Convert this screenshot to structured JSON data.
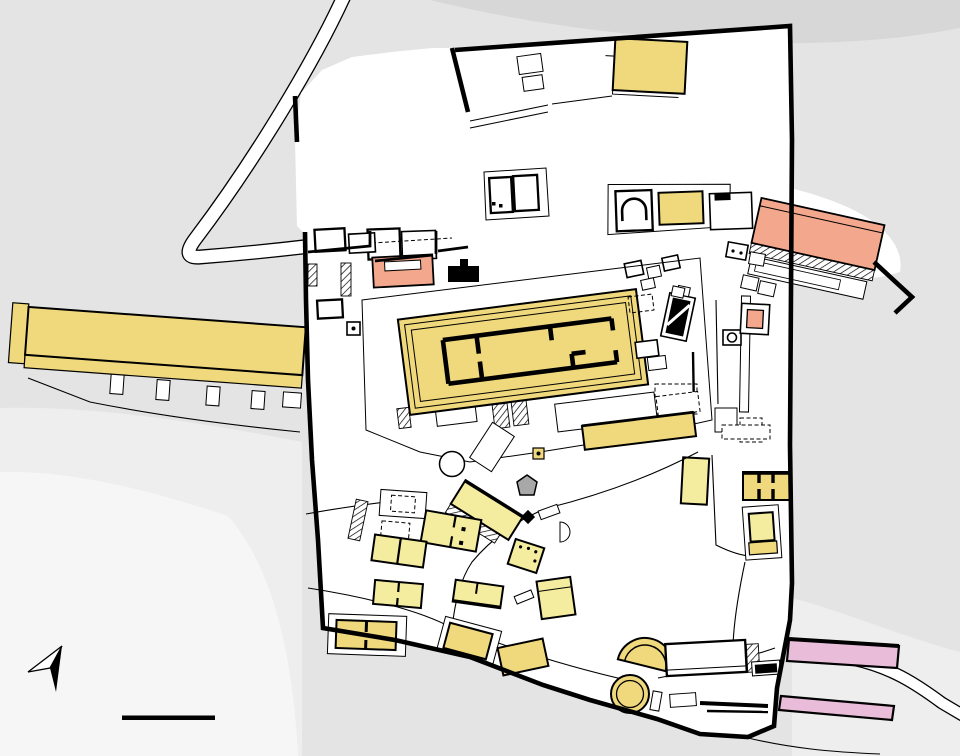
{
  "labels": [
    {
      "n": "1",
      "x": 519,
      "y": 354
    },
    {
      "n": "2",
      "x": 663,
      "y": 326
    },
    {
      "n": "3",
      "x": 628,
      "y": 514
    },
    {
      "n": "4",
      "x": 514,
      "y": 542
    },
    {
      "n": "5",
      "x": 735,
      "y": 495
    },
    {
      "n": "6",
      "x": 392,
      "y": 200
    },
    {
      "n": "7",
      "x": 511,
      "y": 168
    },
    {
      "n": "8",
      "x": 470,
      "y": 472
    },
    {
      "n": "9",
      "x": 729,
      "y": 219
    },
    {
      "n": "10",
      "x": 700,
      "y": 60
    },
    {
      "n": "11",
      "x": 636,
      "y": 470
    },
    {
      "n": "12",
      "x": 818,
      "y": 243
    },
    {
      "n": "13",
      "x": 154,
      "y": 316
    },
    {
      "n": "14",
      "x": 450,
      "y": 563
    },
    {
      "n": "15",
      "x": 440,
      "y": 641
    },
    {
      "n": "16",
      "x": 546,
      "y": 682
    },
    {
      "n": "17",
      "x": 581,
      "y": 608
    },
    {
      "n": "18",
      "x": 424,
      "y": 597
    },
    {
      "n": "19",
      "x": 556,
      "y": 564
    },
    {
      "n": "20",
      "x": 693,
      "y": 523
    },
    {
      "n": "21",
      "x": 759,
      "y": 574
    },
    {
      "n": "22",
      "x": 500,
      "y": 587
    },
    {
      "n": "23",
      "x": 371,
      "y": 560
    },
    {
      "n": "24",
      "x": 366,
      "y": 666
    },
    {
      "n": "25",
      "x": 548,
      "y": 494
    },
    {
      "n": "26",
      "x": 684,
      "y": 286
    },
    {
      "n": "27",
      "x": 667,
      "y": 370
    },
    {
      "n": "28",
      "x": 521,
      "y": 459
    },
    {
      "n": "29",
      "x": 736,
      "y": 360
    },
    {
      "n": "30",
      "x": 679,
      "y": 215
    },
    {
      "n": "31",
      "x": 408,
      "y": 306
    },
    {
      "n": "32",
      "x": 767,
      "y": 352
    },
    {
      "n": "33",
      "x": 637,
      "y": 664
    },
    {
      "n": "34",
      "x": 631,
      "y": 700
    },
    {
      "n": "35",
      "x": 586,
      "y": 697
    },
    {
      "n": "36",
      "x": 712,
      "y": 696
    },
    {
      "n": "37",
      "x": 765,
      "y": 691
    },
    {
      "n": "38",
      "x": 812,
      "y": 103
    },
    {
      "n": "39",
      "x": 838,
      "y": 688
    },
    {
      "n": "40",
      "x": 936,
      "y": 689
    },
    {
      "n": "41",
      "x": 288,
      "y": 34
    }
  ],
  "north": {
    "label": "N"
  },
  "scale_bar": {
    "start": "0",
    "middle": "25",
    "end": "50 m"
  },
  "colors": {
    "building_gold": "#f0d87c",
    "building_pale": "#f4eda0",
    "roman_salmon": "#f3a88d",
    "roman_pink": "#e9bcd9",
    "theater_fill": "#e9c7d2",
    "theater_line": "#5b2a45",
    "background": "#e4e4e4",
    "background_dark": "#d7d7d7",
    "background_light": "#eeeeee",
    "background_lighter": "#f6f6f6",
    "sanctuary_white": "#ffffff",
    "rock_gray": "#a8a8a8",
    "wall_black": "#000000"
  }
}
